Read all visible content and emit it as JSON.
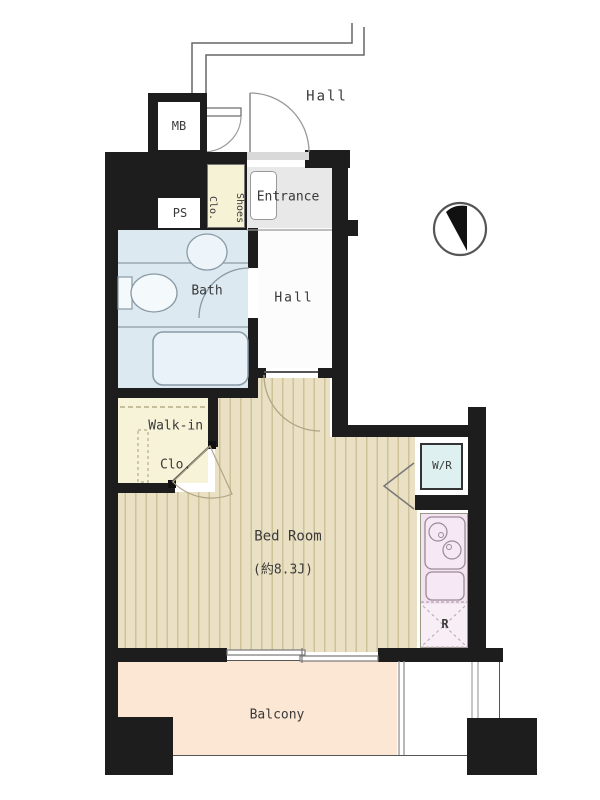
{
  "plan_type": "apartment-floor-plan",
  "rooms": {
    "hall_corridor": {
      "label": "Hall"
    },
    "meter_box": {
      "label": "MB"
    },
    "pipe_space": {
      "label": "PS"
    },
    "shoes_closet": {
      "label_line1": "Shoes",
      "label_line2": "Clo."
    },
    "entrance": {
      "label": "Entrance"
    },
    "bath": {
      "label": "Bath"
    },
    "hall_inner": {
      "label": "Hall"
    },
    "walk_in_closet": {
      "label_line1": "Walk-in",
      "label_line2": "Clo."
    },
    "bedroom": {
      "label": "Bed Room",
      "size": "(約8.3J)"
    },
    "washer_room": {
      "label": "W/R"
    },
    "refrigerator": {
      "label": "R"
    },
    "balcony": {
      "label": "Balcony"
    }
  },
  "icons": {
    "compass": "north-indicator"
  },
  "colors": {
    "wall": "#1d1d1d",
    "bath_floor": "#dce9f1",
    "entrance_floor": "#e8e8e8",
    "closet_floor": "#f7f3d9",
    "bedroom_floor": "#eae0c3",
    "bedroom_stripe": "#cfc29a",
    "kitchen": "#f3e2f0",
    "refrigerator_area": "#f8eef6",
    "washer_room": "#def0f0",
    "balcony": "#fbe7d3"
  }
}
